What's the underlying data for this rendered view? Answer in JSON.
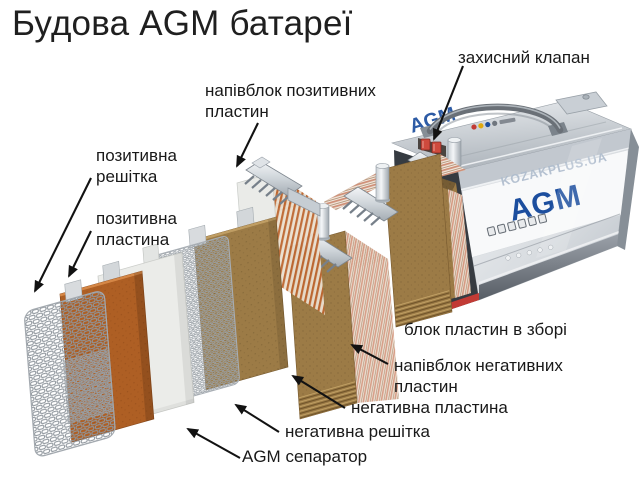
{
  "title": "Будова AGM батареї",
  "callouts": {
    "protective_valve": "захисний клапан",
    "positive_halfblock": "напівблок позитивних пластин",
    "positive_grid": "позитивна решітка",
    "positive_plate": "позитивна пластина",
    "assembled_block": "блок пластин в зборі",
    "negative_halfblock": "напівблок негативних пластин",
    "negative_plate": "негативна пластина",
    "negative_grid": "негативна решітка",
    "agm_separator": "AGM сепаратор"
  },
  "battery": {
    "front_logo": "AGM",
    "top_logo": "AGM",
    "watermark": "KOZAKPLUS.UA"
  },
  "colors": {
    "agm_blue": "#1c4e9e",
    "watermark_blue": "#aebccd",
    "positive_plate_orange": "#ae5f24",
    "negative_plate_brown": "#9c7b46",
    "valve_red": "#cf4a3d",
    "seal_red": "#c23b35",
    "label_text": "#191919"
  }
}
